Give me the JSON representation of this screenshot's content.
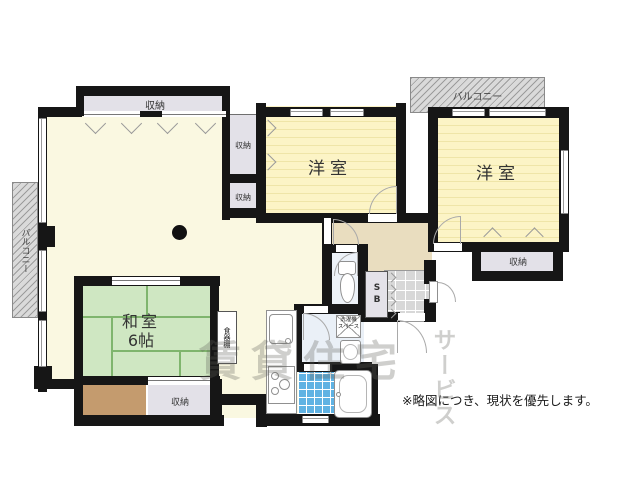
{
  "floorplan": {
    "note": "※略図につき、現状を優先します。",
    "watermark": {
      "horizontal": "賃貸住宅",
      "vertical": "サービス"
    },
    "rooms": {
      "japanese_room_name": "和室",
      "japanese_room_size": "6帖",
      "western_room_left": "洋室",
      "western_room_right": "洋室"
    },
    "features": {
      "storage": "収納",
      "balcony": "バルコニー",
      "dish_cabinet": "食器棚",
      "shoe_box": "SB",
      "washer_space_line1": "洗濯機",
      "washer_space_line2": "スペース"
    },
    "colors": {
      "wall": "#161616",
      "ldk_floor": "#FAF8E1",
      "western_room_floor": "#FBF2BE",
      "japanese_room_floor": "#CFE7C2",
      "hallway_floor": "#E9DDBF",
      "storage_fill": "#E3E1E8",
      "wet_area_floor": "#EAF0F7",
      "bathroom_tile": "#5FB2E3",
      "wood_box": "#C49B6E",
      "balcony_fill": "#DADADA"
    }
  }
}
